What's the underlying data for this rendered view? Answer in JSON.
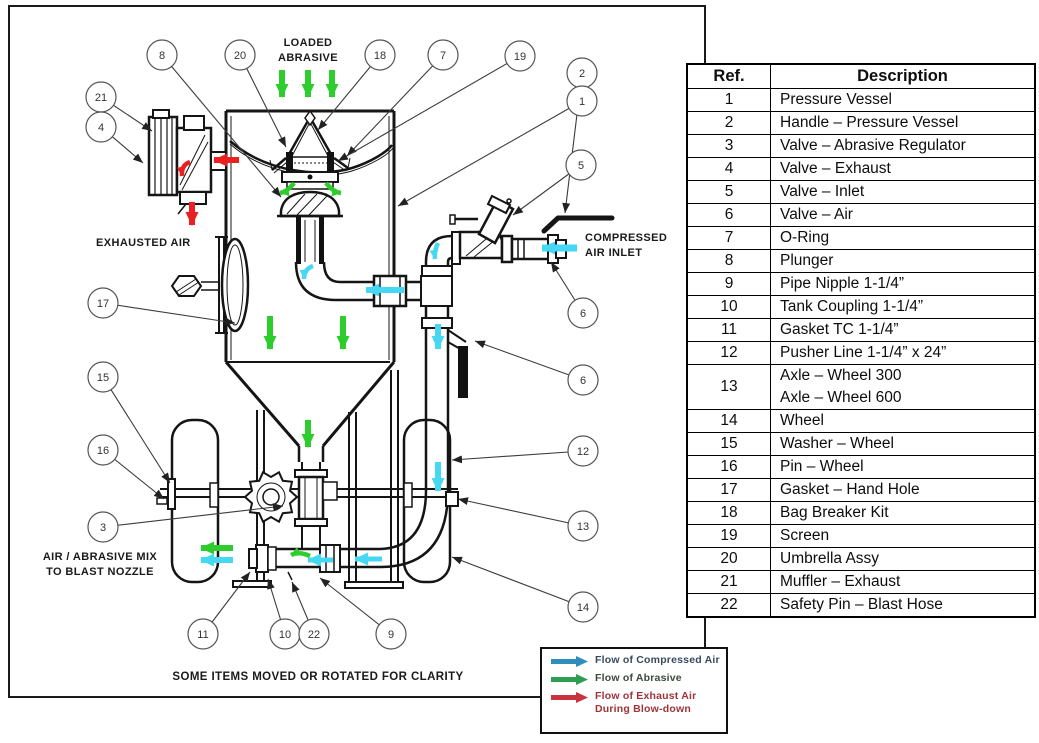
{
  "diagram": {
    "labels": {
      "loaded_abrasive": [
        "LOADED",
        "ABRASIVE"
      ],
      "exhausted_air": "EXHAUSTED AIR",
      "compressed_air_inlet": [
        "COMPRESSED",
        "AIR INLET"
      ],
      "blast_nozzle": [
        "AIR / ABRASIVE MIX",
        "TO BLAST NOZZLE"
      ],
      "clarity_note": "SOME ITEMS MOVED OR ROTATED FOR CLARITY"
    },
    "flow_colors": {
      "compressed_air": "#46D7F2",
      "abrasive": "#2DCD2D",
      "exhaust": "#EB2023"
    },
    "callouts": [
      {
        "n": "8",
        "x": 162,
        "y": 55,
        "tx": 281,
        "ty": 197
      },
      {
        "n": "20",
        "x": 240,
        "y": 55,
        "tx": 286,
        "ty": 147
      },
      {
        "n": "18",
        "x": 380,
        "y": 55,
        "tx": 318,
        "ty": 130
      },
      {
        "n": "7",
        "x": 443,
        "y": 55,
        "tx": 347,
        "ty": 156
      },
      {
        "n": "19",
        "x": 520,
        "y": 56,
        "tx": 338,
        "ty": 161
      },
      {
        "n": "2",
        "x": 582,
        "y": 73,
        "tx": 565,
        "ty": 213
      },
      {
        "n": "1",
        "x": 582,
        "y": 101,
        "tx": 398,
        "ty": 206
      },
      {
        "n": "21",
        "x": 101,
        "y": 97,
        "tx": 152,
        "ty": 131
      },
      {
        "n": "4",
        "x": 101,
        "y": 127,
        "tx": 143,
        "ty": 163
      },
      {
        "n": "5",
        "x": 581,
        "y": 165,
        "tx": 513,
        "ty": 215
      },
      {
        "n": "6",
        "x": 583,
        "y": 313,
        "tx": 551,
        "ty": 262
      },
      {
        "n": "6",
        "x": 583,
        "y": 380,
        "tx": 475,
        "ty": 341
      },
      {
        "n": "17",
        "x": 103,
        "y": 303,
        "tx": 235,
        "ty": 323
      },
      {
        "n": "15",
        "x": 103,
        "y": 377,
        "tx": 170,
        "ty": 483
      },
      {
        "n": "16",
        "x": 103,
        "y": 450,
        "tx": 164,
        "ty": 499
      },
      {
        "n": "3",
        "x": 103,
        "y": 527,
        "tx": 283,
        "ty": 506
      },
      {
        "n": "12",
        "x": 583,
        "y": 451,
        "tx": 452,
        "ty": 460
      },
      {
        "n": "13",
        "x": 583,
        "y": 526,
        "tx": 458,
        "ty": 499
      },
      {
        "n": "14",
        "x": 583,
        "y": 607,
        "tx": 452,
        "ty": 557
      },
      {
        "n": "11",
        "x": 203,
        "y": 634,
        "tx": 250,
        "ty": 572
      },
      {
        "n": "10",
        "x": 285,
        "y": 634,
        "tx": 268,
        "ty": 579
      },
      {
        "n": "22",
        "x": 314,
        "y": 634,
        "tx": 292,
        "ty": 582
      },
      {
        "n": "9",
        "x": 391,
        "y": 634,
        "tx": 320,
        "ty": 578
      }
    ]
  },
  "parts_table": {
    "headers": [
      "Ref.",
      "Description"
    ],
    "rows": [
      {
        "ref": "1",
        "description": [
          "Pressure Vessel"
        ]
      },
      {
        "ref": "2",
        "description": [
          "Handle – Pressure Vessel"
        ]
      },
      {
        "ref": "3",
        "description": [
          "Valve – Abrasive Regulator"
        ]
      },
      {
        "ref": "4",
        "description": [
          "Valve – Exhaust"
        ]
      },
      {
        "ref": "5",
        "description": [
          "Valve – Inlet"
        ]
      },
      {
        "ref": "6",
        "description": [
          "Valve – Air"
        ]
      },
      {
        "ref": "7",
        "description": [
          "O-Ring"
        ]
      },
      {
        "ref": "8",
        "description": [
          "Plunger"
        ]
      },
      {
        "ref": "9",
        "description": [
          "Pipe Nipple 1-1/4”"
        ]
      },
      {
        "ref": "10",
        "description": [
          "Tank Coupling 1-1/4”"
        ]
      },
      {
        "ref": "11",
        "description": [
          "Gasket TC 1-1/4”"
        ]
      },
      {
        "ref": "12",
        "description": [
          "Pusher Line 1-1/4” x 24”"
        ]
      },
      {
        "ref": "13",
        "description": [
          "Axle – Wheel 300",
          "Axle – Wheel 600"
        ]
      },
      {
        "ref": "14",
        "description": [
          "Wheel"
        ]
      },
      {
        "ref": "15",
        "description": [
          "Washer – Wheel"
        ]
      },
      {
        "ref": "16",
        "description": [
          "Pin – Wheel"
        ]
      },
      {
        "ref": "17",
        "description": [
          "Gasket – Hand Hole"
        ]
      },
      {
        "ref": "18",
        "description": [
          "Bag Breaker Kit"
        ]
      },
      {
        "ref": "19",
        "description": [
          "Screen"
        ]
      },
      {
        "ref": "20",
        "description": [
          "Umbrella Assy"
        ]
      },
      {
        "ref": "21",
        "description": [
          "Muffler – Exhaust"
        ]
      },
      {
        "ref": "22",
        "description": [
          "Safety Pin – Blast Hose"
        ]
      }
    ]
  },
  "legend": {
    "entries": [
      {
        "name": "compressed-air",
        "color": "#2E8FBC",
        "text_color": "#3A4A5E",
        "label": [
          "Flow of Compressed Air"
        ]
      },
      {
        "name": "abrasive",
        "color": "#2F9E52",
        "text_color": "#3C4A3C",
        "label": [
          "Flow of Abrasive"
        ]
      },
      {
        "name": "exhaust",
        "color": "#C73440",
        "text_color": "#9E3339",
        "label": [
          "Flow of Exhaust Air",
          "During Blow-down"
        ]
      }
    ]
  }
}
